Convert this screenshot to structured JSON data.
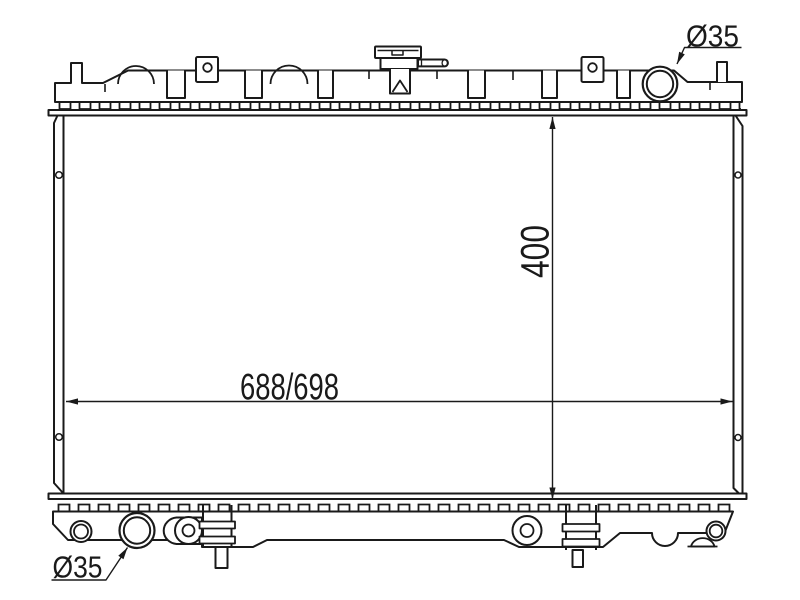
{
  "labels": {
    "width_dim": "688/698",
    "height_dim": "400",
    "top_pipe_dia": "Ø35",
    "bottom_pipe_dia": "Ø35"
  },
  "colors": {
    "line": "#1a1a1a",
    "background": "#ffffff"
  }
}
